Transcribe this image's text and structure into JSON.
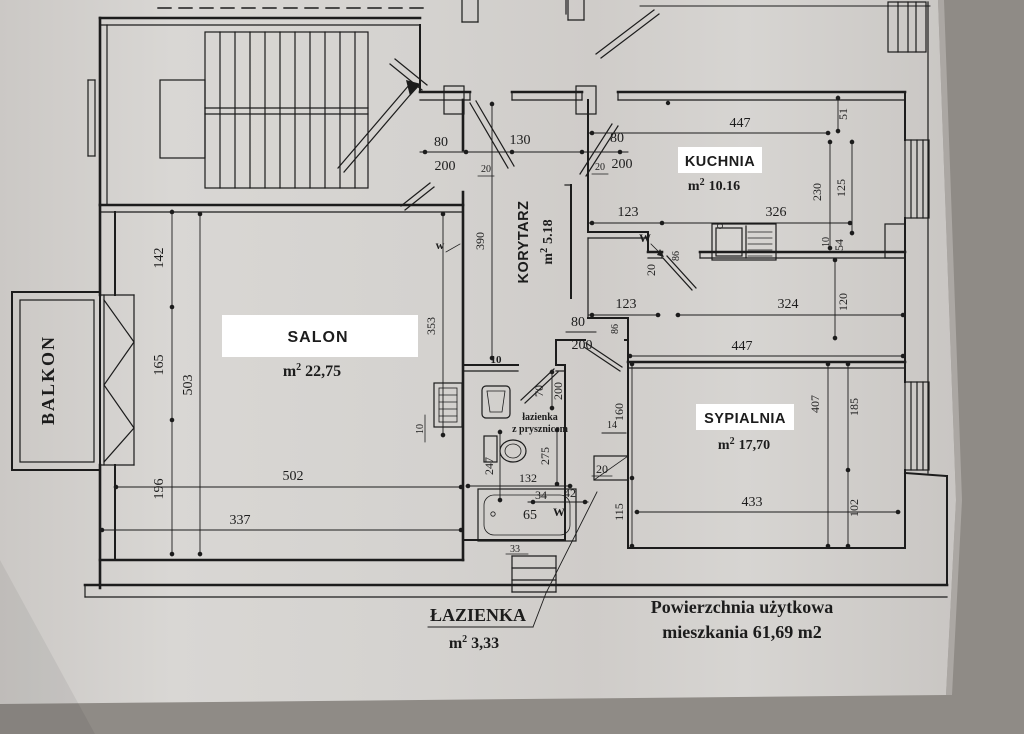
{
  "colors": {
    "ink": "#1c1c1c",
    "paper": "#d5d3d0",
    "backdrop": "#a9a5a1",
    "bottom_band": "#96928d",
    "label_bg": "#ffffff"
  },
  "rooms": {
    "balkon": {
      "name": "BALKON"
    },
    "salon": {
      "name": "SALON",
      "unit": "m",
      "sup": "2",
      "area": "22,75"
    },
    "korytarz": {
      "name": "KORYTARZ",
      "unit": "m",
      "sup": "2",
      "area": "5.18"
    },
    "kuchnia": {
      "name": "KUCHNIA",
      "unit": "m",
      "sup": "2",
      "area": "10.16"
    },
    "sypialnia": {
      "name": "SYPIALNIA",
      "unit": "m",
      "sup": "2",
      "area": "17,70"
    },
    "lazienka": {
      "name": "ŁAZIENKA",
      "unit": "m",
      "sup": "2",
      "area": "3,33",
      "note1": "łazienka",
      "note2": "z prysznicem"
    }
  },
  "summary": {
    "line1": "Powierzchnia użytkowa",
    "line2": "mieszkania 61,69 m2"
  },
  "symbols": {
    "vent_salon": "w",
    "vent_kitchen": "W",
    "vent_bath": "W"
  },
  "dims": {
    "top_door_left_w": "80",
    "top_door_left_h": "200",
    "top_jamb_left": "20",
    "top_width": "130",
    "top_door_right_w": "80",
    "top_door_right_h": "200",
    "top_jamb_right": "20",
    "kitchen_top": "447",
    "k_51": "51",
    "k_230": "230",
    "k_125": "125",
    "k_123": "123",
    "k_326": "326",
    "k_10": "10",
    "k_54": "54",
    "k_20": "20",
    "k_86": "86",
    "mid_123": "123",
    "mid_324": "324",
    "mid_120": "120",
    "bed_top": "447",
    "bed_depth": "407",
    "bed_185": "185",
    "bed_102": "102",
    "bed_bottom": "433",
    "bed_160": "160",
    "bed_115": "115",
    "bed_14": "14",
    "bed_42": "42",
    "bed_34": "34",
    "bed_20": "20",
    "bed_86": "86",
    "bed_door_w": "80",
    "bed_door_h": "200",
    "salon_142": "142",
    "salon_165": "165",
    "salon_196": "196",
    "salon_503": "503",
    "salon_353": "353",
    "salon_390": "390",
    "salon_502": "502",
    "salon_337": "337",
    "salon_10a": "10",
    "salon_10b": "10",
    "bath_door_w": "70",
    "bath_door_h": "200",
    "bath_247": "247",
    "bath_275": "275",
    "bath_132": "132",
    "bath_65": "65",
    "bath_33": "33"
  }
}
